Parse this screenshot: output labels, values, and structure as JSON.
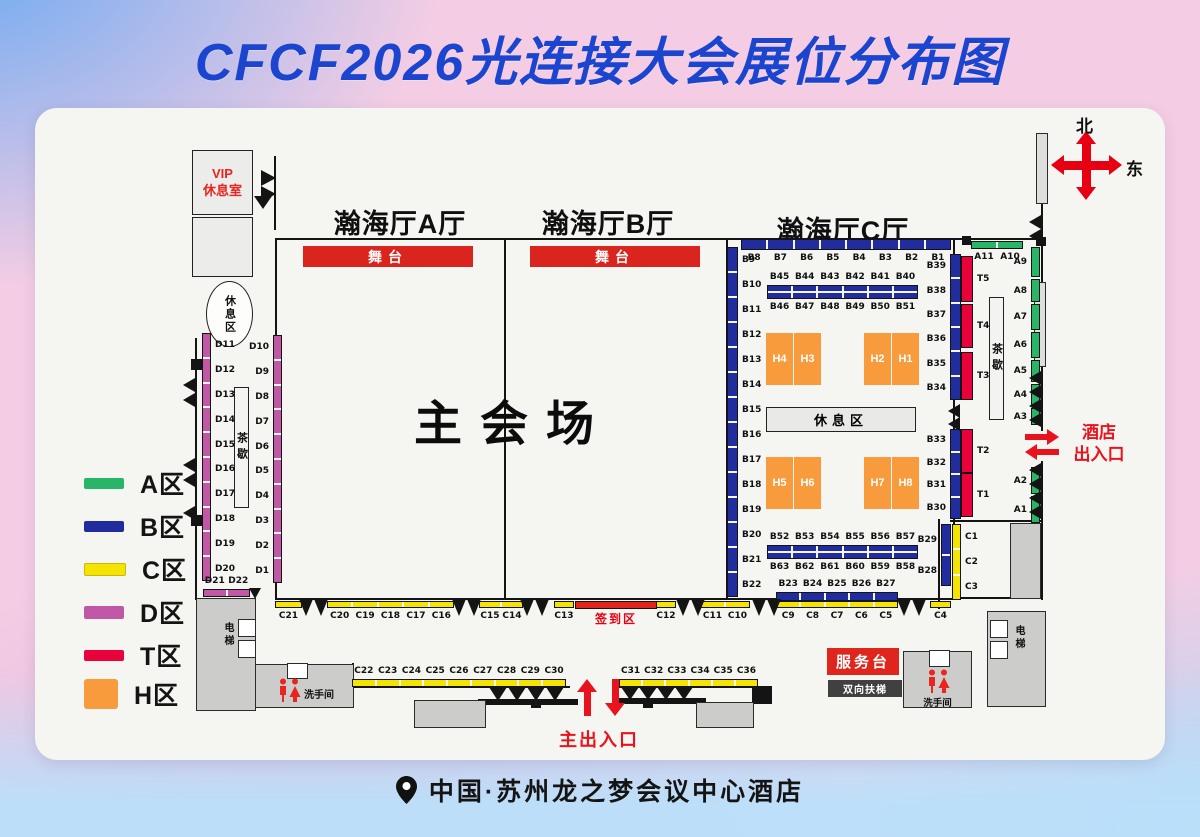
{
  "title": "CFCF2026光连接大会展位分布图",
  "compass": {
    "north": "北",
    "east": "东"
  },
  "hall_titles": {
    "a": "瀚海厅A厅",
    "b": "瀚海厅B厅",
    "c": "瀚海厅C厅"
  },
  "facilities": {
    "vip_line1": "VIP",
    "vip_line2": "休息室",
    "rest_oval": "休息区",
    "rest_box": "休息区",
    "stage": "舞台",
    "main_venue": "主会场",
    "tea_break": "茶歇",
    "checkin": "签到区",
    "service_desk": "服务台",
    "escalator": "双向扶梯",
    "restroom": "洗手间",
    "elevator": "电梯",
    "main_entrance": "主出入口",
    "hotel_entrance_l1": "酒店",
    "hotel_entrance_l2": "出入口"
  },
  "footer": {
    "location": "中国·苏州龙之梦会议中心酒店",
    "pin_icon": "location-pin"
  },
  "legend": {
    "items": [
      {
        "label": "A区",
        "color": "#29b567"
      },
      {
        "label": "B区",
        "color": "#212c9e"
      },
      {
        "label": "C区",
        "color": "#f5e400"
      },
      {
        "label": "D区",
        "color": "#c158a6"
      },
      {
        "label": "T区",
        "color": "#e8013a"
      },
      {
        "label": "H区",
        "color": "#f79b3d"
      }
    ]
  },
  "zone_colors": {
    "A": "#29b567",
    "B": "#212c9e",
    "C": "#f5e400",
    "D": "#c158a6",
    "T": "#e8013a",
    "H": "#f79b3d"
  },
  "accent_colors": {
    "red": "#d9251d",
    "arrow_red": "#e8131c",
    "title_blue": "#1c45cf",
    "compass_red": "#e60012",
    "vip_red": "#e8251f"
  },
  "booth_groups": [
    {
      "id": "c-top",
      "zone": "B",
      "dir": "h",
      "x": 741,
      "y": 239,
      "w": 210,
      "h": 11,
      "side": "below",
      "labels": [
        "B8",
        "B7",
        "B6",
        "B5",
        "B4",
        "B3",
        "B2",
        "B1"
      ]
    },
    {
      "id": "c-left",
      "zone": "B",
      "dir": "v",
      "x": 727,
      "y": 247,
      "w": 11,
      "h": 350,
      "side": "right",
      "labels": [
        "B9",
        "B10",
        "B11",
        "B12",
        "B13",
        "B14",
        "B15",
        "B16",
        "B17",
        "B18",
        "B19",
        "B20",
        "B21",
        "B22"
      ]
    },
    {
      "id": "c-mid1",
      "zone": "B",
      "dir": "h",
      "x": 767,
      "y": 285,
      "w": 151,
      "h": 14,
      "side": "above",
      "dbl": true,
      "labels": [
        "B45",
        "B44",
        "B43",
        "B42",
        "B41",
        "B40"
      ],
      "labels2": [
        "B46",
        "B47",
        "B48",
        "B49",
        "B50",
        "B51"
      ],
      "side2": "below"
    },
    {
      "id": "c-mid2",
      "zone": "B",
      "dir": "h",
      "x": 767,
      "y": 545,
      "w": 151,
      "h": 14,
      "side": "above",
      "dbl": true,
      "labels": [
        "B52",
        "B53",
        "B54",
        "B55",
        "B56",
        "B57"
      ],
      "labels2": [
        "B63",
        "B62",
        "B61",
        "B60",
        "B59",
        "B58"
      ],
      "side2": "below"
    },
    {
      "id": "c-right-top",
      "zone": "B",
      "dir": "v",
      "x": 950,
      "y": 254,
      "w": 11,
      "h": 146,
      "side": "left",
      "labels": [
        "B39",
        "B38",
        "B37",
        "B36",
        "B35",
        "B34"
      ]
    },
    {
      "id": "c-right-bot",
      "zone": "B",
      "dir": "v",
      "x": 950,
      "y": 429,
      "w": 11,
      "h": 90,
      "side": "left",
      "labels": [
        "B33",
        "B32",
        "B31",
        "B30"
      ]
    },
    {
      "id": "t-col",
      "zone": "T",
      "side": "right",
      "segs": [
        [
          "T5",
          961,
          256,
          12,
          46
        ],
        [
          "T4",
          961,
          304,
          12,
          44
        ],
        [
          "T3",
          961,
          352,
          12,
          48
        ],
        [
          "T2",
          961,
          429,
          12,
          44
        ],
        [
          "T1",
          961,
          473,
          12,
          44
        ]
      ]
    },
    {
      "id": "b29-28",
      "zone": "B",
      "dir": "v",
      "x": 941,
      "y": 524,
      "w": 10,
      "h": 62,
      "side": "left",
      "labels": [
        "B29",
        "B28"
      ]
    },
    {
      "id": "c1-3",
      "zone": "C",
      "dir": "v",
      "x": 952,
      "y": 524,
      "w": 9,
      "h": 76,
      "side": "right",
      "labels": [
        "C1",
        "C2",
        "C3"
      ]
    },
    {
      "id": "c21",
      "zone": "C",
      "dir": "h",
      "x": 275,
      "y": 601,
      "w": 27,
      "h": 7,
      "side": "below",
      "labels": [
        "C21"
      ]
    },
    {
      "id": "c20-16",
      "zone": "C",
      "dir": "h",
      "x": 327,
      "y": 601,
      "w": 127,
      "h": 7,
      "side": "below",
      "labels": [
        "C20",
        "C19",
        "C18",
        "C17",
        "C16"
      ]
    },
    {
      "id": "c15-14",
      "zone": "C",
      "dir": "h",
      "x": 479,
      "y": 601,
      "w": 44,
      "h": 7,
      "side": "below",
      "labels": [
        "C15",
        "C14"
      ]
    },
    {
      "id": "c13",
      "zone": "C",
      "dir": "h",
      "x": 554,
      "y": 601,
      "w": 20,
      "h": 7,
      "side": "below",
      "labels": [
        "C13"
      ]
    },
    {
      "id": "c12",
      "zone": "C",
      "dir": "h",
      "x": 656,
      "y": 601,
      "w": 20,
      "h": 7,
      "side": "below",
      "labels": [
        "C12"
      ]
    },
    {
      "id": "c11-10",
      "zone": "C",
      "dir": "h",
      "x": 700,
      "y": 601,
      "w": 50,
      "h": 7,
      "side": "below",
      "labels": [
        "C11",
        "C10"
      ]
    },
    {
      "id": "c9-5",
      "zone": "C",
      "dir": "h",
      "x": 776,
      "y": 601,
      "w": 122,
      "h": 7,
      "side": "below",
      "labels": [
        "C9",
        "C8",
        "C7",
        "C6",
        "C5"
      ]
    },
    {
      "id": "c4",
      "zone": "C",
      "dir": "h",
      "x": 930,
      "y": 601,
      "w": 21,
      "h": 7,
      "side": "below",
      "labels": [
        "C4"
      ]
    },
    {
      "id": "b23-27",
      "zone": "B",
      "dir": "h",
      "x": 776,
      "y": 592,
      "w": 122,
      "h": 9,
      "side": "above",
      "labels": [
        "B23",
        "B24",
        "B25",
        "B26",
        "B27"
      ]
    },
    {
      "id": "c22-30",
      "zone": "C",
      "dir": "h",
      "x": 352,
      "y": 679,
      "w": 214,
      "h": 8,
      "side": "above",
      "labels": [
        "C22",
        "C23",
        "C24",
        "C25",
        "C26",
        "C27",
        "C28",
        "C29",
        "C30"
      ]
    },
    {
      "id": "c31-36",
      "zone": "C",
      "dir": "h",
      "x": 619,
      "y": 679,
      "w": 139,
      "h": 8,
      "side": "above",
      "labels": [
        "C31",
        "C32",
        "C33",
        "C34",
        "C35",
        "C36"
      ]
    },
    {
      "id": "d-left",
      "zone": "D",
      "dir": "v",
      "x": 202,
      "y": 333,
      "w": 9,
      "h": 248,
      "side": "right",
      "labels": [
        "D11",
        "D12",
        "D13",
        "D14",
        "D15",
        "D16",
        "D17",
        "D18",
        "D19",
        "D20"
      ]
    },
    {
      "id": "d-right",
      "zone": "D",
      "dir": "v",
      "x": 273,
      "y": 335,
      "w": 9,
      "h": 248,
      "side": "left",
      "labels": [
        "D10",
        "D9",
        "D8",
        "D7",
        "D6",
        "D5",
        "D4",
        "D3",
        "D2",
        "D1"
      ]
    },
    {
      "id": "d21-22",
      "zone": "D",
      "dir": "h",
      "x": 203,
      "y": 589,
      "w": 47,
      "h": 8,
      "side": "above",
      "labels": [
        "D21",
        "D22"
      ]
    },
    {
      "id": "a-top",
      "zone": "A",
      "dir": "h",
      "x": 971,
      "y": 241,
      "w": 52,
      "h": 8,
      "side": "below",
      "labels": [
        "A11",
        "A10"
      ]
    },
    {
      "id": "a-col",
      "zone": "A",
      "side": "left",
      "segs": [
        [
          "A9",
          1031,
          247,
          9,
          30
        ],
        [
          "A8",
          1031,
          279,
          9,
          23
        ],
        [
          "A7",
          1031,
          304,
          9,
          26
        ],
        [
          "A6",
          1031,
          332,
          9,
          26
        ],
        [
          "A5",
          1031,
          360,
          9,
          22
        ],
        [
          "A4",
          1031,
          384,
          9,
          22
        ],
        [
          "A3",
          1031,
          408,
          9,
          17
        ],
        [
          "A2",
          1031,
          467,
          9,
          27
        ],
        [
          "A1",
          1031,
          496,
          9,
          27
        ]
      ]
    }
  ],
  "h_blocks": {
    "cell": {
      "w": 27,
      "h": 52
    },
    "blocks": [
      {
        "x": 766,
        "y": 333,
        "labels": [
          "H4",
          "H3"
        ]
      },
      {
        "x": 864,
        "y": 333,
        "labels": [
          "H2",
          "H1"
        ]
      },
      {
        "x": 766,
        "y": 457,
        "labels": [
          "H5",
          "H6"
        ]
      },
      {
        "x": 864,
        "y": 457,
        "labels": [
          "H7",
          "H8"
        ]
      }
    ]
  }
}
